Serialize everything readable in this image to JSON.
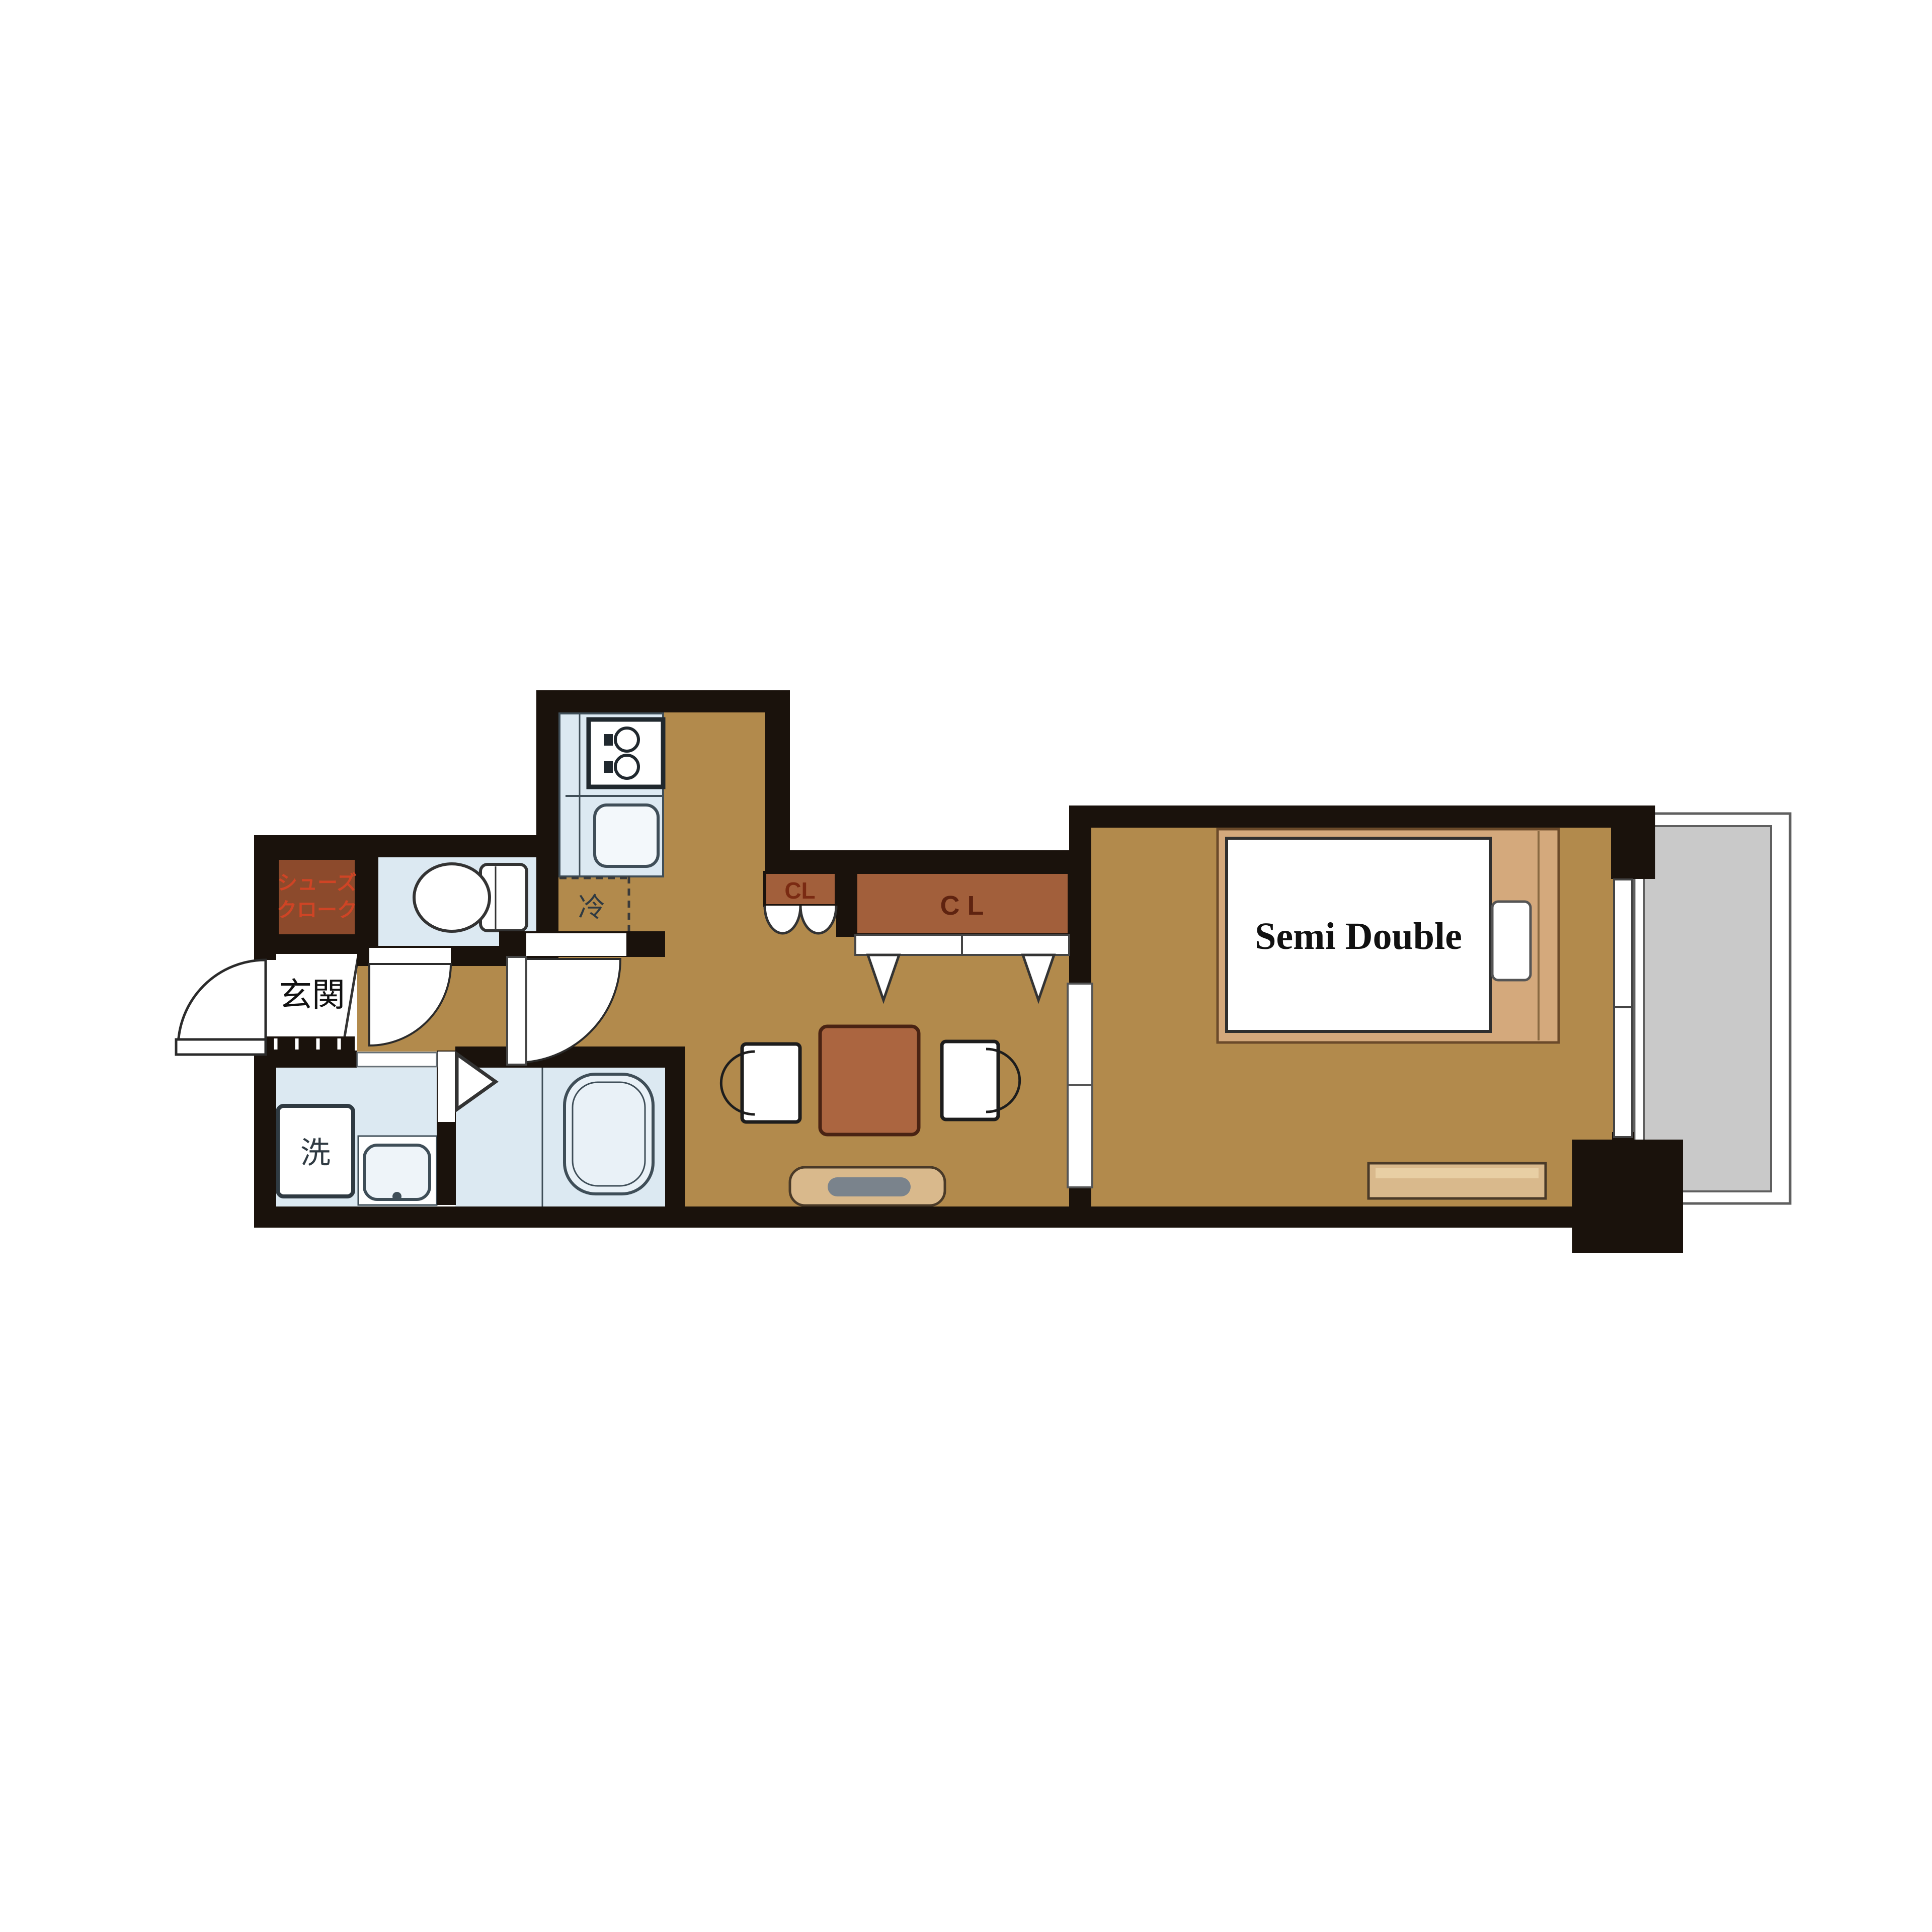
{
  "plan_title": "1K apartment floor plan",
  "colors": {
    "wall": "#1a120c",
    "floor": "#b28a4c",
    "wet_room": "#dce9f2",
    "genkan": "#ffffff",
    "closet": "#a25f3b",
    "shoe_closet": "#8c4a2c",
    "balcony": "#c9c9c9",
    "bed_frame": "#d4a97c",
    "mattress": "#ffffff",
    "furniture": "#d9b98c",
    "table": "#ab6540",
    "tv": "#7a838c",
    "label_red": "#cf4425",
    "label_maroon": "#7a2a12",
    "label_brown": "#5f2310",
    "label_dark": "#2f3a42",
    "label_black": "#111111"
  },
  "labels": {
    "shoe_closet_line1": "シューズ",
    "shoe_closet_line2": "クローク",
    "entrance": "玄関",
    "closet_small": "CL",
    "closet_large": "C L",
    "fridge": "冷",
    "washer": "洗",
    "bed": "Semi Double"
  }
}
